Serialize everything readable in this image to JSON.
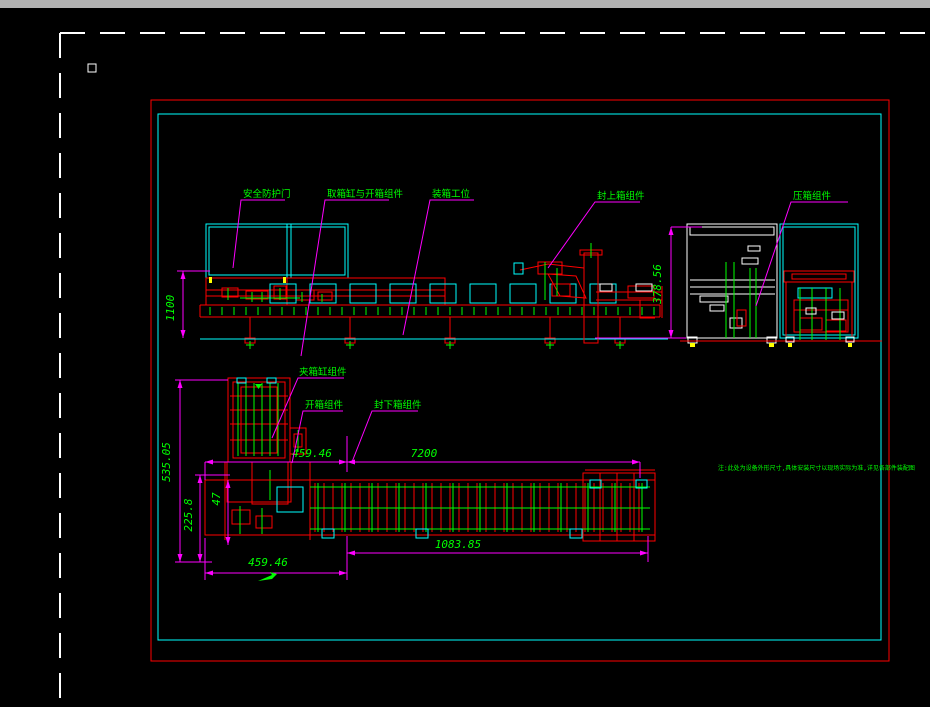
{
  "app": {
    "titlebar_color": "#b2b2b2"
  },
  "colors": {
    "background": "#000000",
    "frame_red": "#ff0000",
    "frame_cyan": "#00ffff",
    "dimension_magenta": "#ff00ff",
    "text_green": "#00ff00",
    "line_white": "#ffffff",
    "accent_yellow": "#ffff00"
  },
  "callouts": {
    "safety_door": "安全防护门",
    "pick_open_box": "取箱缸与开箱组件",
    "packing_station": "装箱工位",
    "seal_top_box": "封上箱组件",
    "press_box": "压箱组件",
    "clamp_cylinder": "夹箱缸组件",
    "open_box": "开箱组件",
    "seal_bottom_box": "封下箱组件"
  },
  "dims": {
    "front_height": "1100",
    "end_height": "378.56",
    "plan_depth": "535.05",
    "plan_inner_depth": "225.8",
    "plan_small": "47",
    "infeed_length": "459.46",
    "total_length": "7200",
    "outfeed_length": "1083.85",
    "infeed_length_2": "459.46"
  },
  "note": "注:此处为设备外形尺寸,具体安装尺寸以现场实际为准,详见各部件装配图"
}
